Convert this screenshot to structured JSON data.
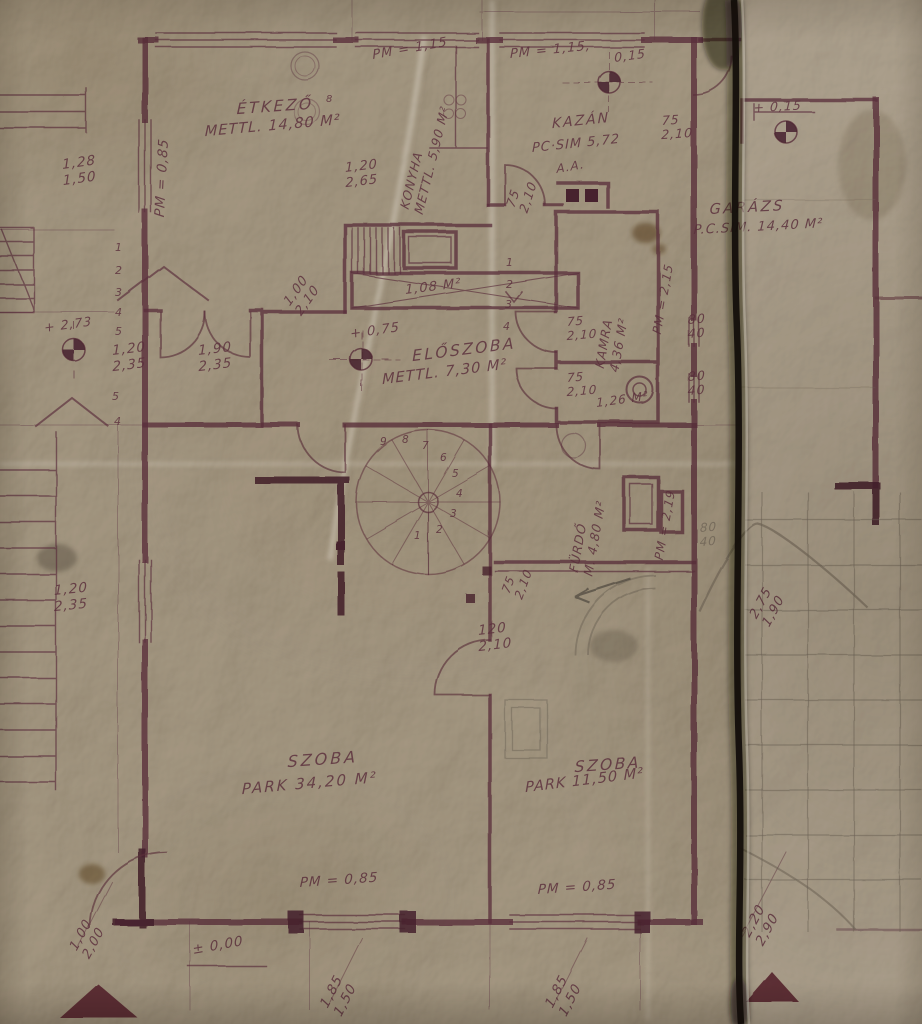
{
  "document": {
    "kind": "hand-drawn architectural floor plan on aged folded paper",
    "language": "Hungarian"
  },
  "colors": {
    "paper": "#c6bcae",
    "ink": "#5b2f3c",
    "ink_strong": "#47222d",
    "pencil": "#6e6457",
    "fold": "#140f0b",
    "stain": "#7d5820"
  },
  "labels": {
    "rooms": {
      "etkezo_name": "ÉTKEZŐ",
      "etkezo_area": "METTL. 14,80 M²",
      "konyha": "KONYHA\nMETTL. 5,90 M²",
      "kazan_name": "KAZÁN",
      "kazan_area": "PC·SIM 5,72",
      "garazs_name": "GARÁZS",
      "garazs_area": "P.C.SIM. 14,40 M²",
      "eloszoba_name": "ELŐSZOBA",
      "eloszoba_area": "METTL. 7,30 M²",
      "kamra": "KAMRA\n4,36 M²",
      "furdo": "FÜRDŐ\nM. 4,80 M²",
      "wc_area": "1,26 M²",
      "shaft_area": "1,08 M²",
      "szoba1_name": "SZOBA",
      "szoba1_area": "PARK 34,20 M²",
      "szoba2_name": "SZOBA",
      "szoba2_area": "PARK 11,50 M²"
    },
    "pm": {
      "left": "PM = 0,85",
      "mid": "PM = 1,15",
      "kazan": "PM = 1,15,",
      "kazan2": "0,15",
      "kamra": "PM = 2,15",
      "furdo": "PM = 2,19",
      "bottom1": "PM = 0,85",
      "bottom2": "PM = 0,85"
    },
    "levels": {
      "l015": "+ 0,15",
      "l075": "+ 0,75",
      "l273": "+ 2,73",
      "l000": "± 0,00"
    },
    "dims": {
      "d128_150": "1,28\n1,50",
      "d120_265": "1,20\n2,65",
      "d120_235a": "1,20\n2,35",
      "d190_235": "1,90\n2,35",
      "d120_235b": "1,20\n2,35",
      "d100_210": "1,00\n2,10",
      "d75_210_kazan": "75\n2,10",
      "d75_210_r": "75\n2,10",
      "d75_210_a": "75\n2,10",
      "d75_210_b": "75\n2,10",
      "d75_210_f": "75\n2,10",
      "d80_40_a": "80\n40",
      "d80_40_b": "80\n40",
      "d80_40_c": "80\n40",
      "d120_210": "120\n2,10",
      "d275_190": "2,75\n1,90",
      "d185_150_a": "1,85\n1,50",
      "d185_150_b": "1,85\n1,50",
      "d220_290": "2,20\n2,90",
      "d100_200": "1,00\n2,00"
    },
    "marks": {
      "section": "A.A.",
      "note8": "8"
    },
    "steps": {
      "left": [
        "1",
        "2",
        "3",
        "4",
        "5",
        "5",
        "4"
      ],
      "right": [
        "1",
        "2",
        "3",
        "4"
      ],
      "spiral": [
        "1",
        "2",
        "3",
        "4",
        "5",
        "6",
        "7",
        "8",
        "9"
      ]
    }
  }
}
